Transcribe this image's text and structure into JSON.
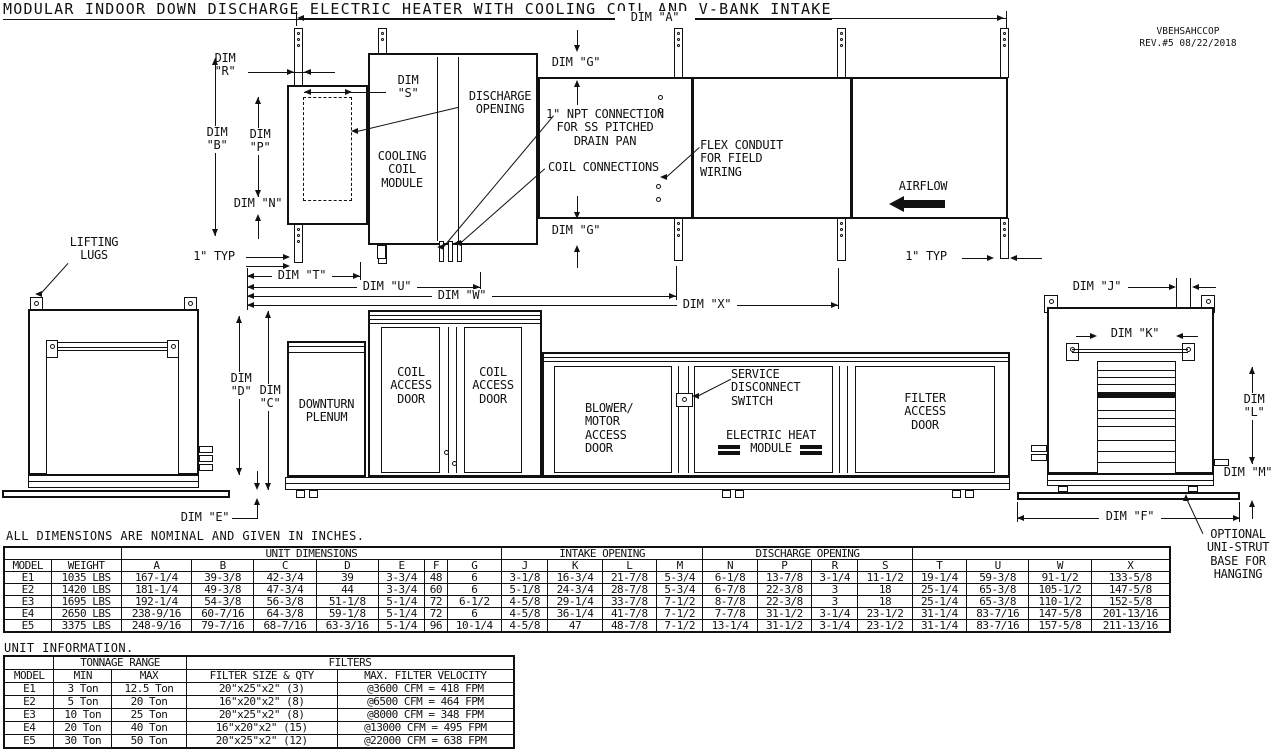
{
  "title": "MODULAR INDOOR DOWN DISCHARGE ELECTRIC HEATER WITH COOLING COIL AND V-BANK INTAKE",
  "title_block": {
    "model_code": "VBEHSAHCCOP",
    "revision": "REV.#5  08/22/2018"
  },
  "plan_view": {
    "dim_a": "DIM \"A\"",
    "dim_b": "DIM\n\"B\"",
    "dim_g": "DIM \"G\"",
    "dim_n": "DIM \"N\"",
    "dim_p": "DIM\n\"P\"",
    "dim_r": "DIM\n\"R\"",
    "dim_s": "DIM\n\"S\"",
    "dim_t": "DIM \"T\"",
    "dim_u": "DIM \"U\"",
    "dim_w": "DIM \"W\"",
    "dim_x": "DIM \"X\"",
    "one_inch_typ": "1\" TYP",
    "cooling_coil_module": "COOLING\nCOIL\nMODULE",
    "discharge_opening": "DISCHARGE\nOPENING",
    "npt_connection": "1\" NPT CONNECTION\nFOR SS PITCHED\nDRAIN PAN",
    "coil_connections": "COIL CONNECTIONS",
    "flex_conduit": "FLEX CONDUIT\nFOR FIELD\nWIRING",
    "airflow": "AIRFLOW"
  },
  "elevation_view": {
    "lifting_lugs": "LIFTING\nLUGS",
    "dim_c": "DIM\n\"C\"",
    "dim_d": "DIM\n\"D\"",
    "dim_e": "DIM \"E\"",
    "dim_f": "DIM \"F\"",
    "dim_j": "DIM \"J\"",
    "dim_k": "DIM \"K\"",
    "dim_l": "DIM\n\"L\"",
    "dim_m": "DIM \"M\"",
    "downturn_plenum": "DOWNTURN\nPLENUM",
    "coil_access_door": "COIL\nACCESS\nDOOR",
    "blower_motor_access_door": "BLOWER/\nMOTOR\nACCESS\nDOOR",
    "service_disconnect_switch": "SERVICE\nDISCONNECT\nSWITCH",
    "electric_heat_module": "ELECTRIC HEAT\nMODULE",
    "filter_access_door": "FILTER\nACCESS\nDOOR",
    "optional_unistrut": "OPTIONAL\nUNI-STRUT\nBASE FOR\nHANGING"
  },
  "notes": {
    "dimensions_note": "ALL DIMENSIONS ARE NOMINAL AND GIVEN IN INCHES."
  },
  "unit_dimensions_table": {
    "groups": [
      {
        "label": "",
        "span": 2
      },
      {
        "label": "UNIT DIMENSIONS",
        "span": 7
      },
      {
        "label": "INTAKE OPENING",
        "span": 4
      },
      {
        "label": "DISCHARGE OPENING",
        "span": 4
      },
      {
        "label": "",
        "span": 4
      }
    ],
    "headers": [
      "MODEL",
      "WEIGHT",
      "A",
      "B",
      "C",
      "D",
      "E",
      "F",
      "G",
      "J",
      "K",
      "L",
      "M",
      "N",
      "P",
      "R",
      "S",
      "T",
      "U",
      "W",
      "X"
    ],
    "rows": [
      [
        "E1",
        "1035 LBS",
        "167-1/4",
        "39-3/8",
        "42-3/4",
        "39",
        "3-3/4",
        "48",
        "6",
        "3-1/8",
        "16-3/4",
        "21-7/8",
        "5-3/4",
        "6-1/8",
        "13-7/8",
        "3-1/4",
        "11-1/2",
        "19-1/4",
        "59-3/8",
        "91-1/2",
        "133-5/8"
      ],
      [
        "E2",
        "1420 LBS",
        "181-1/4",
        "49-3/8",
        "47-3/4",
        "44",
        "3-3/4",
        "60",
        "6",
        "5-1/8",
        "24-3/4",
        "28-7/8",
        "5-3/4",
        "6-7/8",
        "22-3/8",
        "3",
        "18",
        "25-1/4",
        "65-3/8",
        "105-1/2",
        "147-5/8"
      ],
      [
        "E3",
        "1695 LBS",
        "192-1/4",
        "54-3/8",
        "56-3/8",
        "51-1/8",
        "5-1/4",
        "72",
        "6-1/2",
        "4-5/8",
        "29-1/4",
        "33-7/8",
        "7-1/2",
        "8-7/8",
        "22-3/8",
        "3",
        "18",
        "25-1/4",
        "65-3/8",
        "110-1/2",
        "152-5/8"
      ],
      [
        "E4",
        "2650 LBS",
        "238-9/16",
        "60-7/16",
        "64-3/8",
        "59-1/8",
        "5-1/4",
        "72",
        "6",
        "4-5/8",
        "36-1/4",
        "41-7/8",
        "7-1/2",
        "7-7/8",
        "31-1/2",
        "3-1/4",
        "23-1/2",
        "31-1/4",
        "83-7/16",
        "147-5/8",
        "201-13/16"
      ],
      [
        "E5",
        "3375 LBS",
        "248-9/16",
        "79-7/16",
        "68-7/16",
        "63-3/16",
        "5-1/4",
        "96",
        "10-1/4",
        "4-5/8",
        "47",
        "48-7/8",
        "7-1/2",
        "13-1/4",
        "31-1/2",
        "3-1/4",
        "23-1/2",
        "31-1/4",
        "83-7/16",
        "157-5/8",
        "211-13/16"
      ]
    ]
  },
  "unit_information": {
    "title": "UNIT INFORMATION.",
    "table": {
      "groups": [
        {
          "label": "",
          "span": 1
        },
        {
          "label": "TONNAGE RANGE",
          "span": 2
        },
        {
          "label": "FILTERS",
          "span": 2
        }
      ],
      "headers": [
        "MODEL",
        "MIN",
        "MAX",
        "FILTER SIZE & QTY",
        "MAX. FILTER VELOCITY"
      ],
      "rows": [
        [
          "E1",
          "3 Ton",
          "12.5 Ton",
          "20\"x25\"x2\" (3)",
          "@3600 CFM = 418 FPM"
        ],
        [
          "E2",
          "5 Ton",
          "20 Ton",
          "16\"x20\"x2\" (8)",
          "@6500 CFM = 464 FPM"
        ],
        [
          "E3",
          "10 Ton",
          "25 Ton",
          "20\"x25\"x2\" (8)",
          "@8000 CFM = 348 FPM"
        ],
        [
          "E4",
          "20 Ton",
          "40 Ton",
          "16\"x20\"x2\" (15)",
          "@13000 CFM = 495 FPM"
        ],
        [
          "E5",
          "30 Ton",
          "50 Ton",
          "20\"x25\"x2\" (12)",
          "@22000 CFM = 638 FPM"
        ]
      ]
    }
  }
}
